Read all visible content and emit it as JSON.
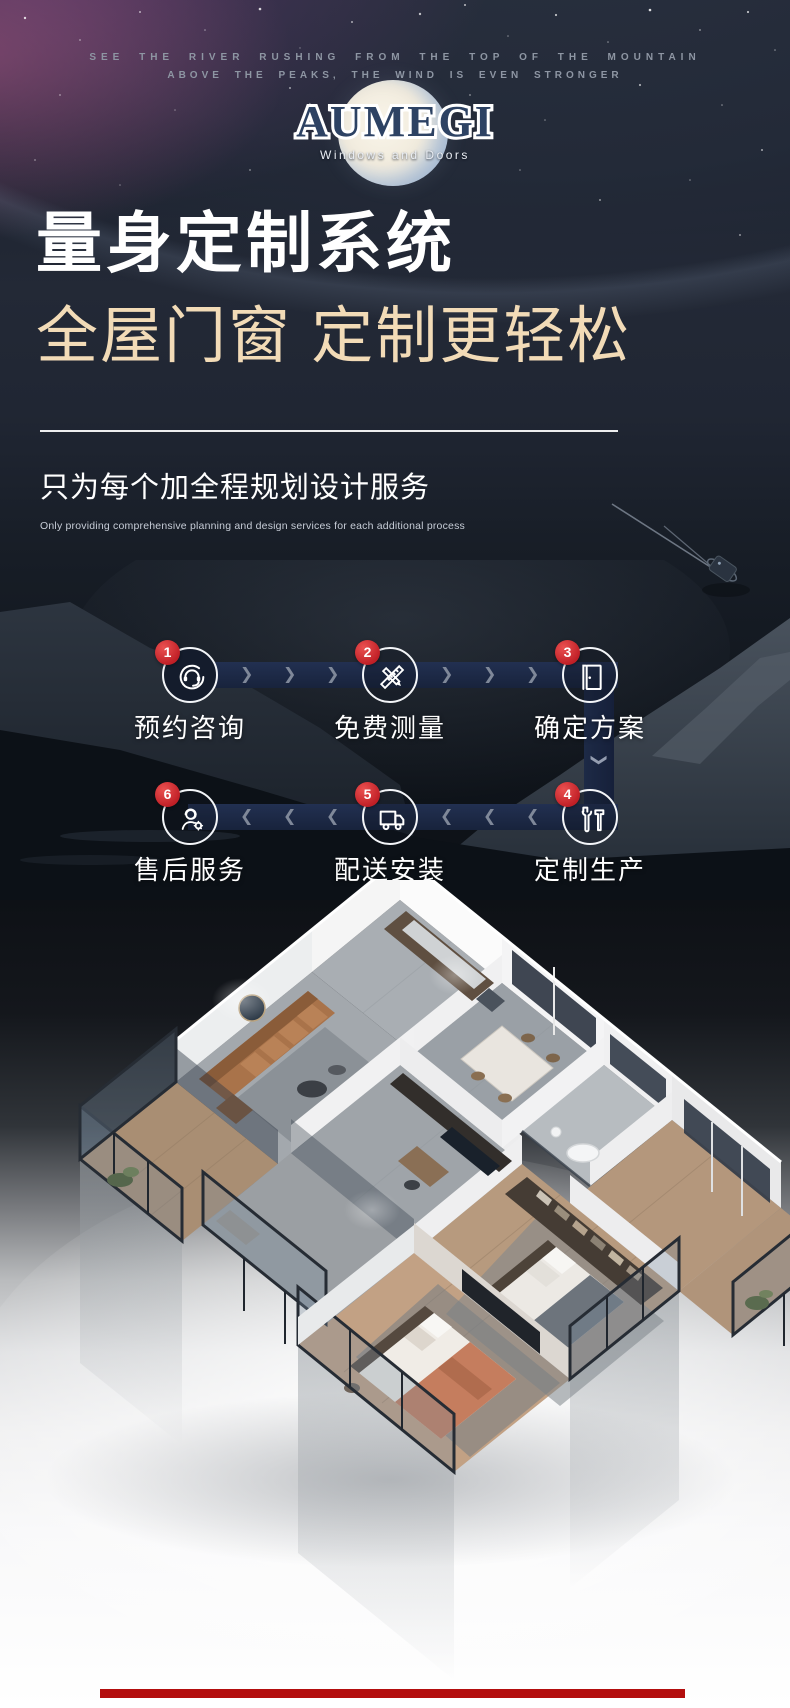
{
  "hero": {
    "tagline_line1": "SEE THE RIVER RUSHING FROM THE TOP OF THE MOUNTAIN",
    "tagline_line2": "ABOVE THE PEAKS, THE WIND IS EVEN STRONGER",
    "logo": {
      "text": "AUMEGI",
      "subtext": "Windows and Doors"
    },
    "headline_primary": "量身定制系统",
    "headline_secondary": "全屋门窗 定制更轻松",
    "subtitle": "只为每个加全程规划设计服务",
    "subtitle_en": "Only providing comprehensive planning and design services for each additional process"
  },
  "process": {
    "steps": [
      {
        "num": "1",
        "label": "预约咨询",
        "icon": "headset-icon"
      },
      {
        "num": "2",
        "label": "免费测量",
        "icon": "pencil-ruler-icon"
      },
      {
        "num": "3",
        "label": "确定方案",
        "icon": "door-icon"
      },
      {
        "num": "4",
        "label": "定制生产",
        "icon": "tools-icon"
      },
      {
        "num": "5",
        "label": "配送安装",
        "icon": "truck-icon"
      },
      {
        "num": "6",
        "label": "售后服务",
        "icon": "aftersale-service-icon"
      }
    ]
  },
  "colors": {
    "headline_gold": "#f2dbb7",
    "logo_navy": "#2d4263",
    "flow_band_navy": "#1c2840",
    "badge_red": "#c6242a",
    "bottom_bar_red": "#b30e0e"
  }
}
